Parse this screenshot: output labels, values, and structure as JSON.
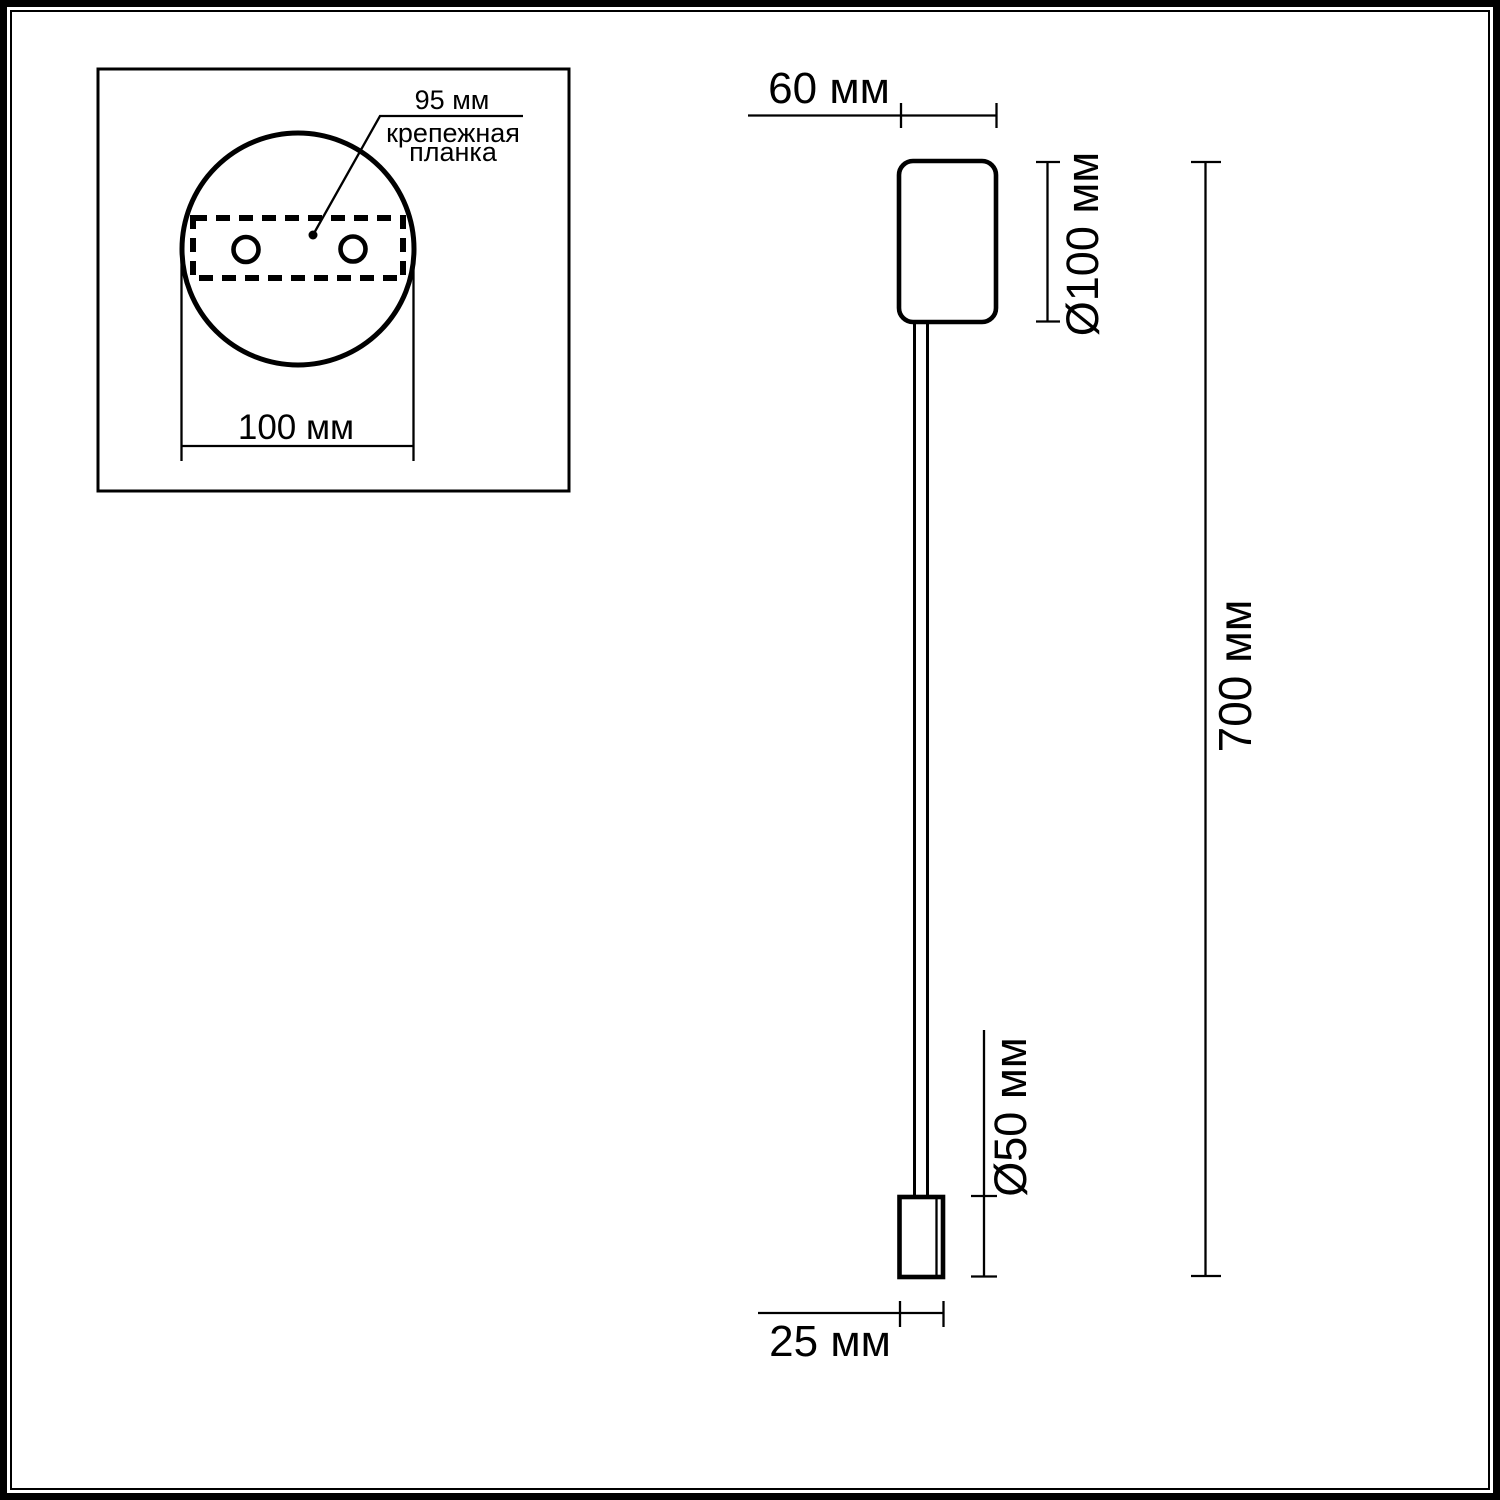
{
  "inset": {
    "labels": {
      "hole_spacing": "95 мм",
      "mount_plate_line1": "крепежная",
      "mount_plate_line2": "планка",
      "base_width": "100 мм"
    }
  },
  "side_view": {
    "labels": {
      "body_width": "60 мм",
      "base_diameter": "Ø100 мм",
      "total_height": "700 мм",
      "head_diameter": "Ø50 мм",
      "head_width": "25 мм"
    }
  },
  "colors": {
    "line": "#000000",
    "background": "#ffffff"
  }
}
